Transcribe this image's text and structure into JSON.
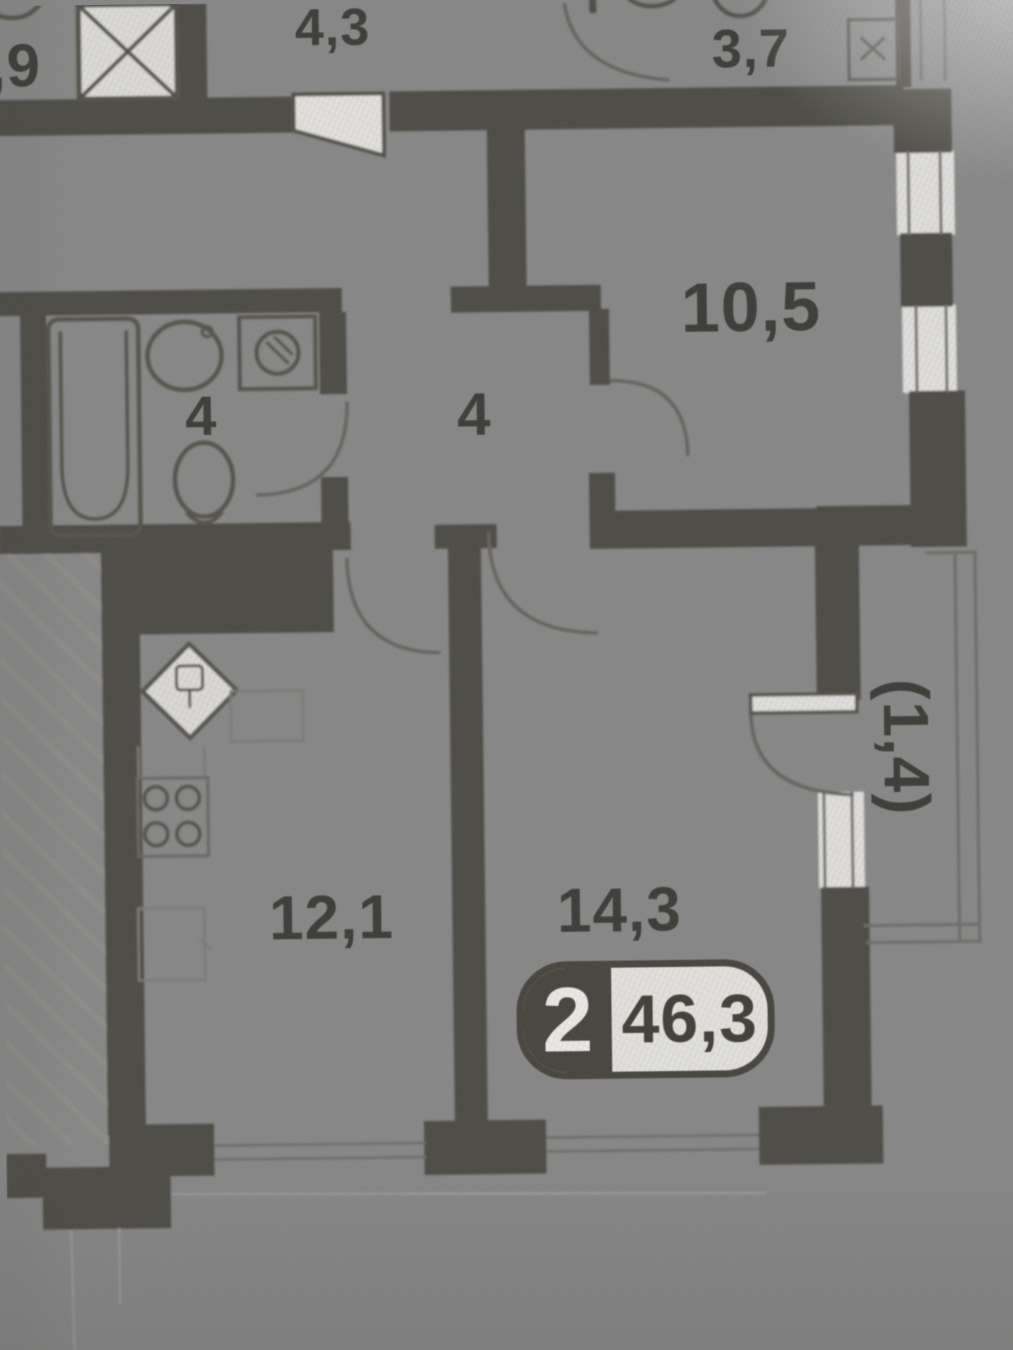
{
  "plan": {
    "type": "apartment-floor-plan-photo",
    "labels": {
      "partial_top_left": ",9",
      "hall": "4,3",
      "wc_top": "3,7",
      "bedroom": "10,5",
      "bathroom": "4",
      "corridor": "4",
      "kitchen": "12,1",
      "living": "14,3",
      "balcony": "(1,4)"
    },
    "badge": {
      "rooms": "2",
      "area": "46,3"
    },
    "colors": {
      "paper": "#d8d7d4",
      "wall": "#504d46",
      "ink": "#403e3a",
      "thin_line": "#6f6d69",
      "hatch": "#8f8d89"
    }
  }
}
